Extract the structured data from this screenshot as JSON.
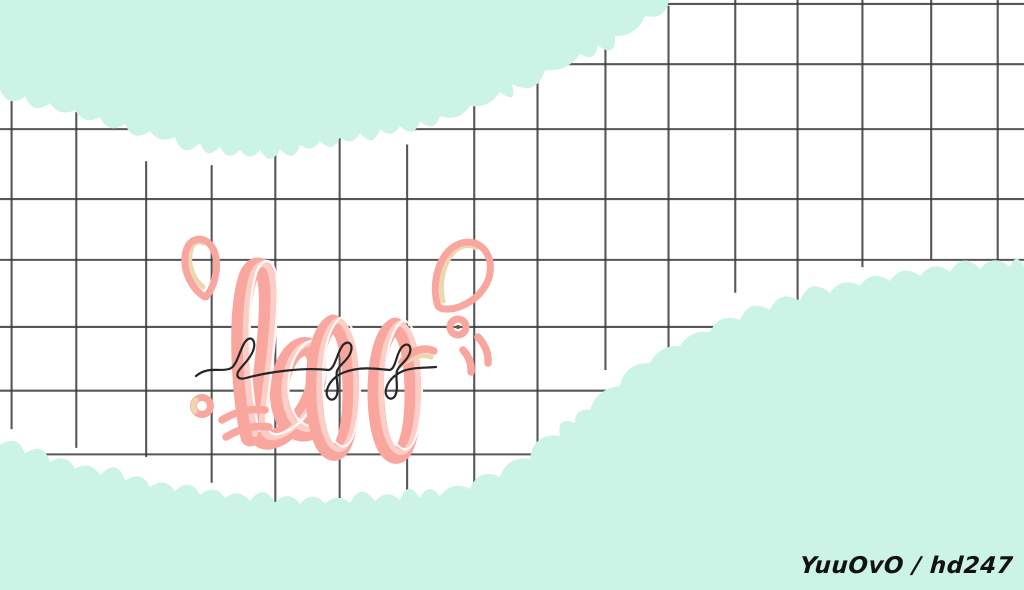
{
  "lettering": {
    "word": "bff"
  },
  "signature": {
    "text": "YuuOvO / hd247"
  },
  "colors": {
    "mint": "#cbf3e6",
    "paper": "#ffffff",
    "grid_line": "#3a3a3a",
    "pink": "#f9a69e",
    "pink_light": "#fdd0c8",
    "beige": "#ecd7b2",
    "ink": "#262626",
    "signature_text": "#121212"
  }
}
